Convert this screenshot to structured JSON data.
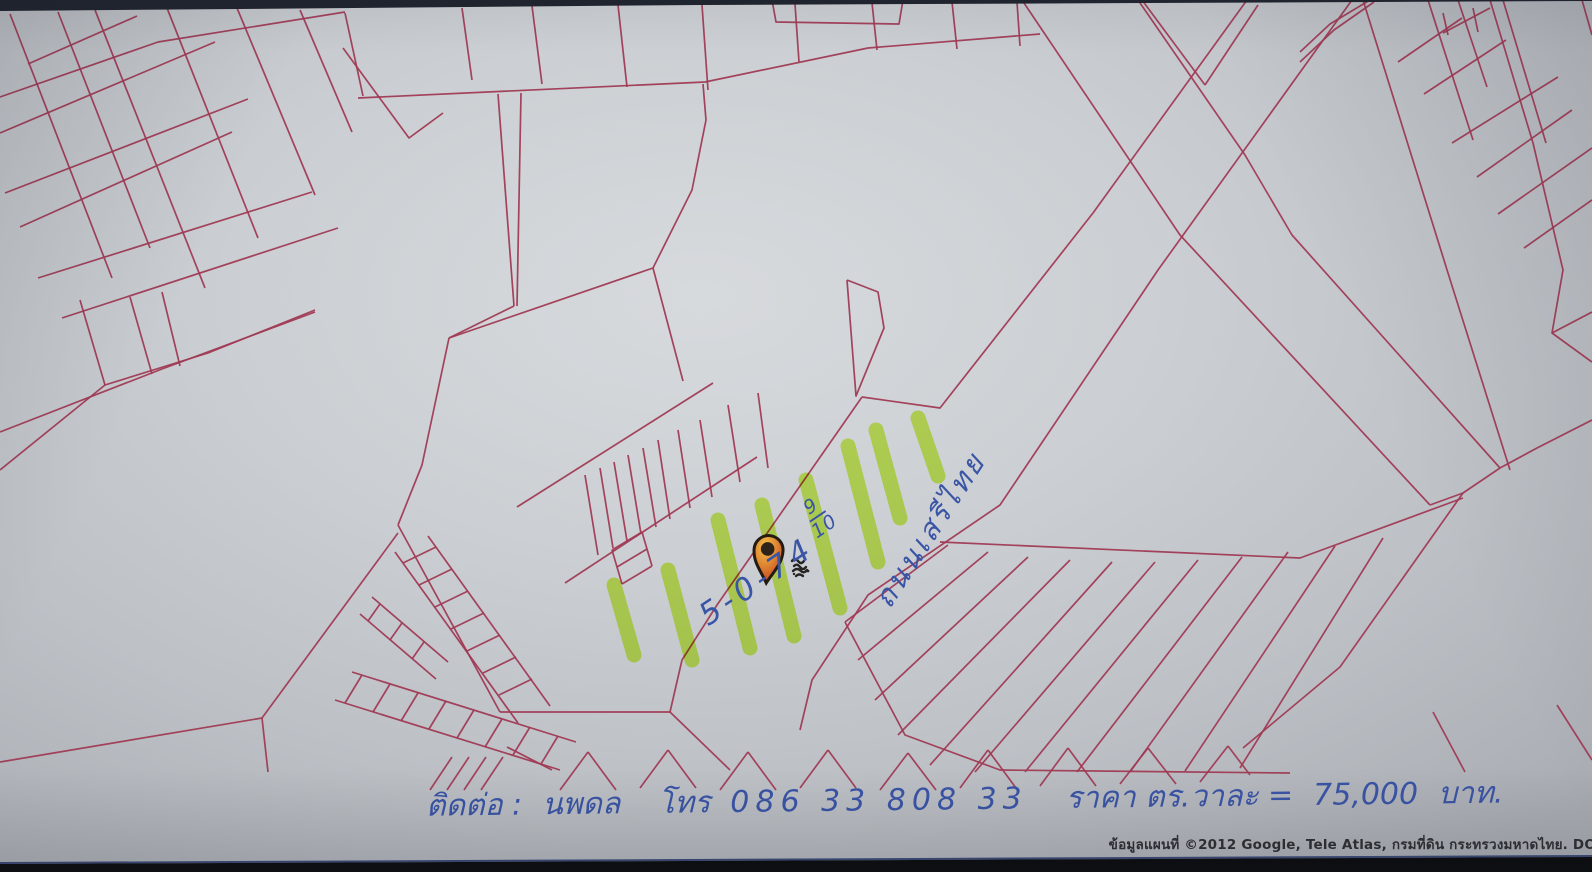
{
  "map": {
    "paper_color": "#cbcfd3",
    "line_color": "#a03a54",
    "highlight_color": "#c9f437",
    "ink_color": "#3a54a6",
    "photo_edge_top_color": "#20242e",
    "photo_edge_bottom_color": "#0b0c0f",
    "photo_edge_line_color": "#3c4a78",
    "pin": {
      "x": 768,
      "y": 551,
      "colors": {
        "outline": "#241c12",
        "top": "#f2c04a",
        "mid": "#e08832",
        "bottom": "#c23a20",
        "center": "#2e241a"
      }
    },
    "scribble": {
      "x": 792,
      "y": 558
    },
    "red_lines": [
      [
        10,
        14,
        112,
        278
      ],
      [
        58,
        12,
        150,
        248
      ],
      [
        95,
        10,
        205,
        288
      ],
      [
        167,
        8,
        258,
        238
      ],
      [
        237,
        8,
        315,
        195
      ],
      [
        300,
        10,
        352,
        132
      ],
      [
        0,
        97,
        158,
        42,
        345,
        12
      ],
      [
        0,
        133,
        215,
        42
      ],
      [
        5,
        193,
        248,
        99
      ],
      [
        20,
        227,
        232,
        132
      ],
      [
        38,
        278,
        312,
        192
      ],
      [
        62,
        318,
        338,
        228
      ],
      [
        28,
        64,
        137,
        16
      ],
      [
        0,
        432,
        162,
        369,
        315,
        312
      ],
      [
        80,
        300,
        105,
        385
      ],
      [
        130,
        297,
        152,
        374
      ],
      [
        162,
        292,
        180,
        366
      ],
      [
        0,
        470,
        105,
        385,
        208,
        353,
        315,
        310
      ],
      [
        462,
        8,
        472,
        80
      ],
      [
        532,
        6,
        542,
        84
      ],
      [
        618,
        5,
        627,
        87
      ],
      [
        702,
        5,
        708,
        90
      ],
      [
        795,
        4,
        799,
        62
      ],
      [
        872,
        3,
        877,
        50
      ],
      [
        952,
        2,
        957,
        49
      ],
      [
        1017,
        2,
        1020,
        46
      ],
      [
        358,
        98,
        705,
        82,
        868,
        48,
        1040,
        34
      ],
      [
        772,
        0,
        776,
        22,
        899,
        24,
        903,
        0
      ],
      [
        345,
        13,
        363,
        96
      ],
      [
        343,
        48,
        409,
        138,
        443,
        113
      ],
      [
        498,
        94,
        514,
        306
      ],
      [
        521,
        93,
        517,
        306
      ],
      [
        514,
        306,
        449,
        338
      ],
      [
        449,
        338,
        653,
        268
      ],
      [
        653,
        268,
        683,
        381
      ],
      [
        653,
        268,
        692,
        190,
        706,
        120,
        703,
        84
      ],
      [
        449,
        338,
        422,
        465,
        398,
        525
      ],
      [
        398,
        525,
        500,
        712
      ],
      [
        517,
        507,
        713,
        383
      ],
      [
        565,
        583,
        757,
        457
      ],
      [
        585,
        475,
        598,
        555
      ],
      [
        600,
        468,
        613,
        548
      ],
      [
        614,
        462,
        627,
        541
      ],
      [
        628,
        455,
        641,
        534
      ],
      [
        643,
        448,
        656,
        527
      ],
      [
        658,
        440,
        670,
        519
      ],
      [
        678,
        430,
        690,
        508
      ],
      [
        700,
        420,
        712,
        497
      ],
      [
        728,
        405,
        740,
        482
      ],
      [
        758,
        393,
        768,
        468
      ],
      [
        612,
        550,
        642,
        532
      ],
      [
        617,
        567,
        647,
        549
      ],
      [
        622,
        584,
        652,
        566
      ],
      [
        612,
        550,
        622,
        584
      ],
      [
        642,
        532,
        652,
        566
      ],
      [
        500,
        712,
        670,
        712
      ],
      [
        670,
        712,
        730,
        770
      ],
      [
        682,
        660,
        670,
        712
      ],
      [
        1247,
        0,
        1093,
        213,
        940,
        408,
        862,
        397
      ],
      [
        862,
        397,
        717,
        605,
        682,
        660
      ],
      [
        847,
        280,
        878,
        292,
        884,
        328,
        856,
        396,
        847,
        280
      ],
      [
        1352,
        0,
        1158,
        270,
        1000,
        505,
        868,
        595,
        812,
        680,
        800,
        730
      ],
      [
        1022,
        0,
        1180,
        235,
        1430,
        505
      ],
      [
        1138,
        0,
        1245,
        155,
        1292,
        235,
        1500,
        468
      ],
      [
        1430,
        505,
        1463,
        493,
        1500,
        468
      ],
      [
        1463,
        493,
        1340,
        667,
        1243,
        748
      ],
      [
        1500,
        468,
        1537,
        448,
        1592,
        420
      ],
      [
        1433,
        712,
        1465,
        772
      ],
      [
        1557,
        705,
        1592,
        760
      ],
      [
        1363,
        0,
        1448,
        273,
        1510,
        470
      ],
      [
        1428,
        0,
        1473,
        140
      ],
      [
        1458,
        0,
        1487,
        87
      ],
      [
        1490,
        0,
        1533,
        143,
        1563,
        270,
        1552,
        333,
        1592,
        362
      ],
      [
        1503,
        0,
        1546,
        143
      ],
      [
        1582,
        0,
        1592,
        35
      ],
      [
        1443,
        13,
        1448,
        35
      ],
      [
        1473,
        8,
        1478,
        32
      ],
      [
        1443,
        33,
        1490,
        8
      ],
      [
        1300,
        52,
        1330,
        24,
        1370,
        0
      ],
      [
        1300,
        62,
        1334,
        30,
        1374,
        2
      ],
      [
        1398,
        62,
        1462,
        18
      ],
      [
        1424,
        94,
        1506,
        40
      ],
      [
        1452,
        143,
        1558,
        77
      ],
      [
        1477,
        177,
        1572,
        110
      ],
      [
        1498,
        214,
        1592,
        148
      ],
      [
        1524,
        248,
        1592,
        200
      ],
      [
        1592,
        312,
        1552,
        333
      ],
      [
        1142,
        0,
        1205,
        85
      ],
      [
        1205,
        85,
        1258,
        5
      ],
      [
        940,
        542,
        1300,
        558,
        1463,
        498
      ],
      [
        948,
        545,
        845,
        622
      ],
      [
        988,
        552,
        858,
        660
      ],
      [
        1028,
        557,
        875,
        700
      ],
      [
        1070,
        560,
        898,
        735
      ],
      [
        1112,
        562,
        930,
        765
      ],
      [
        1155,
        562,
        975,
        772
      ],
      [
        1198,
        560,
        1025,
        772
      ],
      [
        1242,
        557,
        1077,
        772
      ],
      [
        1288,
        552,
        1130,
        772
      ],
      [
        1335,
        546,
        1185,
        771
      ],
      [
        1383,
        538,
        1240,
        768
      ],
      [
        845,
        622,
        905,
        735,
        1000,
        770,
        1290,
        773
      ],
      [
        0,
        762,
        262,
        718,
        398,
        533
      ],
      [
        262,
        718,
        268,
        772
      ],
      [
        395,
        552,
        518,
        723
      ],
      [
        428,
        536,
        550,
        706
      ],
      [
        403,
        563,
        436,
        547
      ],
      [
        419,
        585,
        452,
        569
      ],
      [
        435,
        607,
        468,
        591
      ],
      [
        451,
        629,
        484,
        613
      ],
      [
        467,
        651,
        500,
        635
      ],
      [
        483,
        673,
        516,
        657
      ],
      [
        499,
        695,
        532,
        679
      ],
      [
        335,
        700,
        560,
        770
      ],
      [
        352,
        672,
        576,
        742
      ],
      [
        362,
        675,
        345,
        703
      ],
      [
        390,
        684,
        373,
        712
      ],
      [
        418,
        693,
        401,
        721
      ],
      [
        446,
        701,
        429,
        729
      ],
      [
        474,
        710,
        457,
        738
      ],
      [
        502,
        719,
        485,
        747
      ],
      [
        530,
        727,
        513,
        755
      ],
      [
        558,
        736,
        541,
        764
      ],
      [
        372,
        597,
        448,
        662
      ],
      [
        360,
        614,
        436,
        679
      ],
      [
        380,
        604,
        368,
        621
      ],
      [
        402,
        623,
        390,
        640
      ],
      [
        424,
        642,
        412,
        659
      ],
      [
        507,
        747,
        552,
        770
      ],
      [
        430,
        790,
        452,
        757
      ],
      [
        447,
        790,
        469,
        757
      ],
      [
        464,
        790,
        486,
        757
      ],
      [
        481,
        790,
        503,
        757
      ],
      [
        560,
        790,
        588,
        752
      ],
      [
        588,
        752,
        616,
        790
      ],
      [
        640,
        788,
        668,
        750
      ],
      [
        668,
        750,
        696,
        788
      ],
      [
        720,
        790,
        748,
        752
      ],
      [
        748,
        752,
        776,
        790
      ],
      [
        800,
        788,
        828,
        750
      ],
      [
        828,
        750,
        856,
        788
      ],
      [
        880,
        790,
        908,
        753
      ],
      [
        908,
        753,
        936,
        790
      ],
      [
        960,
        788,
        988,
        750
      ],
      [
        988,
        750,
        1016,
        788
      ],
      [
        1040,
        786,
        1068,
        748
      ],
      [
        1068,
        748,
        1096,
        786
      ],
      [
        1120,
        784,
        1148,
        748
      ],
      [
        1148,
        748,
        1176,
        784
      ],
      [
        1200,
        782,
        1228,
        746
      ],
      [
        1228,
        746,
        1250,
        775
      ]
    ],
    "highlight_strokes": [
      [
        614,
        585,
        634,
        655
      ],
      [
        668,
        570,
        692,
        660
      ],
      [
        718,
        520,
        750,
        648
      ],
      [
        762,
        505,
        794,
        636
      ],
      [
        806,
        480,
        840,
        608
      ],
      [
        848,
        446,
        878,
        562
      ],
      [
        876,
        430,
        900,
        518
      ],
      [
        918,
        418,
        938,
        476
      ]
    ]
  },
  "annotations": {
    "land_area": {
      "main": "5-0-74",
      "fraction_numerator": "9",
      "fraction_denominator": "10"
    },
    "road_label": "ถนนเสรีไทย",
    "contact": {
      "contact_label": "ติดต่อ :",
      "name": "นพดล",
      "tel_label": "โทร",
      "phone": "086 33 808 33",
      "price_label": "ราคา ตร.วาละ =",
      "price": "75,000",
      "unit": "บาท."
    },
    "copyright": "ข้อมูลแผนที่ ©2012 Google, Tele Atlas, กรมที่ดิน กระทรวงมหาดไทย. DO"
  }
}
